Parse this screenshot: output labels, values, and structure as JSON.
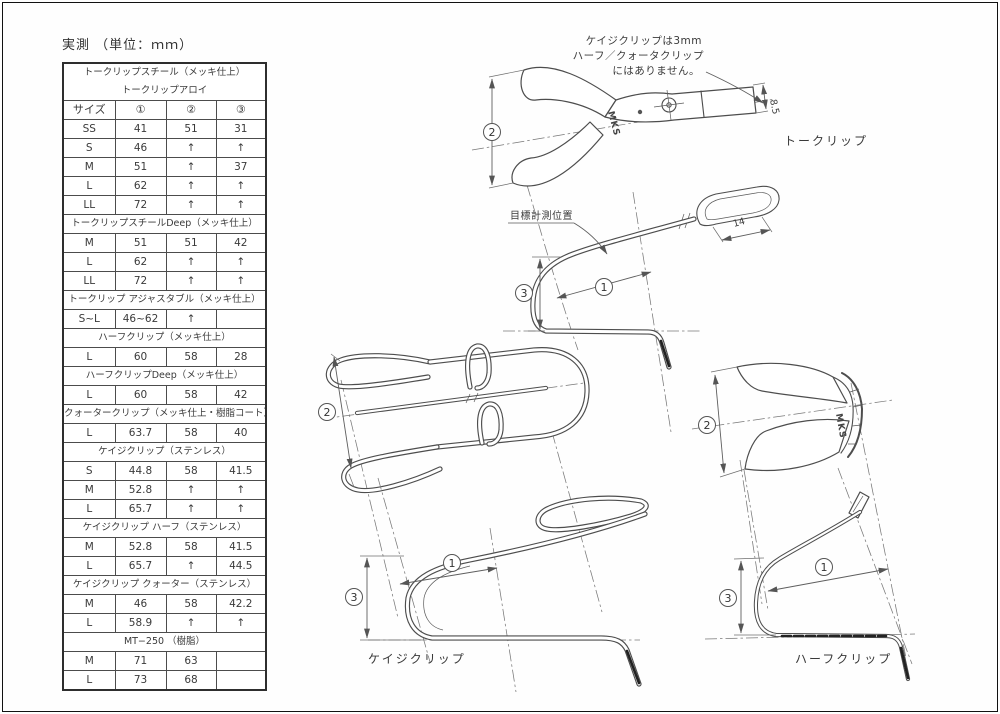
{
  "page": {
    "title": "実測 （単位：ｍｍ）"
  },
  "table": {
    "columns": [
      "サイズ",
      "①",
      "②",
      "③"
    ],
    "sections": [
      {
        "header_lines": [
          "トークリップスチール（メッキ仕上）",
          "トークリップアロイ"
        ],
        "rows": [
          [
            "SS",
            "41",
            "51",
            "31"
          ],
          [
            "S",
            "46",
            "↑",
            "↑"
          ],
          [
            "M",
            "51",
            "↑",
            "37"
          ],
          [
            "L",
            "62",
            "↑",
            "↑"
          ],
          [
            "LL",
            "72",
            "↑",
            "↑"
          ]
        ]
      },
      {
        "header_lines": [
          "トークリップスチールDeep（メッキ仕上）"
        ],
        "rows": [
          [
            "M",
            "51",
            "51",
            "42"
          ],
          [
            "L",
            "62",
            "↑",
            "↑"
          ],
          [
            "LL",
            "72",
            "↑",
            "↑"
          ]
        ]
      },
      {
        "header_lines": [
          "トークリップ アジャスタブル（メッキ仕上）"
        ],
        "rows": [
          [
            "S~L",
            "46~62",
            "↑",
            ""
          ]
        ]
      },
      {
        "header_lines": [
          "ハーフクリップ（メッキ仕上）"
        ],
        "rows": [
          [
            "L",
            "60",
            "58",
            "28"
          ]
        ]
      },
      {
        "header_lines": [
          "ハーフクリップDeep（メッキ仕上）"
        ],
        "rows": [
          [
            "L",
            "60",
            "58",
            "42"
          ]
        ]
      },
      {
        "header_lines": [
          "クォータークリップ（メッキ仕上・樹脂コート）"
        ],
        "rows": [
          [
            "L",
            "63.7",
            "58",
            "40"
          ]
        ]
      },
      {
        "header_lines": [
          "ケイジクリップ（ステンレス）"
        ],
        "rows": [
          [
            "S",
            "44.8",
            "58",
            "41.5"
          ],
          [
            "M",
            "52.8",
            "↑",
            "↑"
          ],
          [
            "L",
            "65.7",
            "↑",
            "↑"
          ]
        ]
      },
      {
        "header_lines": [
          "ケイジクリップ ハーフ（ステンレス）"
        ],
        "rows": [
          [
            "M",
            "52.8",
            "58",
            "41.5"
          ],
          [
            "L",
            "65.7",
            "↑",
            "44.5"
          ]
        ]
      },
      {
        "header_lines": [
          "ケイジクリップ クォーター（ステンレス）"
        ],
        "rows": [
          [
            "M",
            "46",
            "58",
            "42.2"
          ],
          [
            "L",
            "58.9",
            "↑",
            "↑"
          ]
        ]
      },
      {
        "header_lines": [
          "MT−250 （樹脂）"
        ],
        "rows": [
          [
            "M",
            "71",
            "63",
            ""
          ],
          [
            "L",
            "73",
            "68",
            ""
          ]
        ]
      }
    ]
  },
  "annotations": {
    "cage_note_lines": [
      "ケイジクリップは3mm",
      "ハーフ／クォータクリップ",
      "にはありません。"
    ],
    "measure_position": "目標計測位置",
    "logo": "MKS"
  },
  "labels": {
    "toe_clip": "トークリップ",
    "cage_clip": "ケイジクリップ",
    "half_clip": "ハーフクリップ"
  },
  "dims": {
    "c1": "1",
    "c2": "2",
    "c3": "3",
    "plate_width": "8.5",
    "strap_slot": "14"
  }
}
